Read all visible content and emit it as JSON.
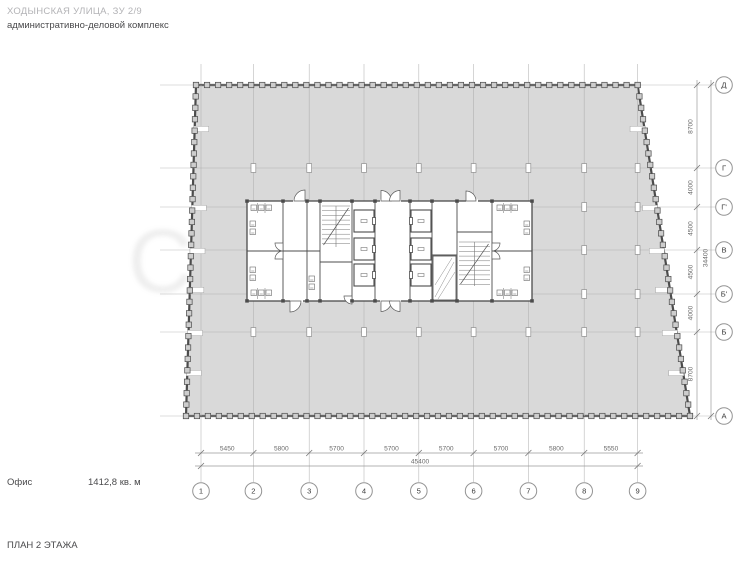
{
  "header": {
    "address": "ХОДЫНСКАЯ УЛИЦА, ЗУ 2/9",
    "building_type": "административно-деловой комплекс"
  },
  "space": {
    "label": "Офис",
    "area": "1412,8 кв. м"
  },
  "plan_title": "ПЛАН 2 ЭТАЖА",
  "watermark": "Cityprofits",
  "grid": {
    "column_axes": [
      "1",
      "2",
      "3",
      "4",
      "5",
      "6",
      "7",
      "8",
      "9"
    ],
    "column_dims": [
      "5450",
      "5800",
      "5700",
      "5700",
      "5700",
      "5700",
      "5800",
      "5550"
    ],
    "column_total": "45400",
    "row_axes": [
      "Д",
      "Г",
      "Г'",
      "В",
      "Б'",
      "Б",
      "А"
    ],
    "row_dims": [
      "8700",
      "4000",
      "4500",
      "4500",
      "4000",
      "8700"
    ],
    "row_total": "34400"
  }
}
